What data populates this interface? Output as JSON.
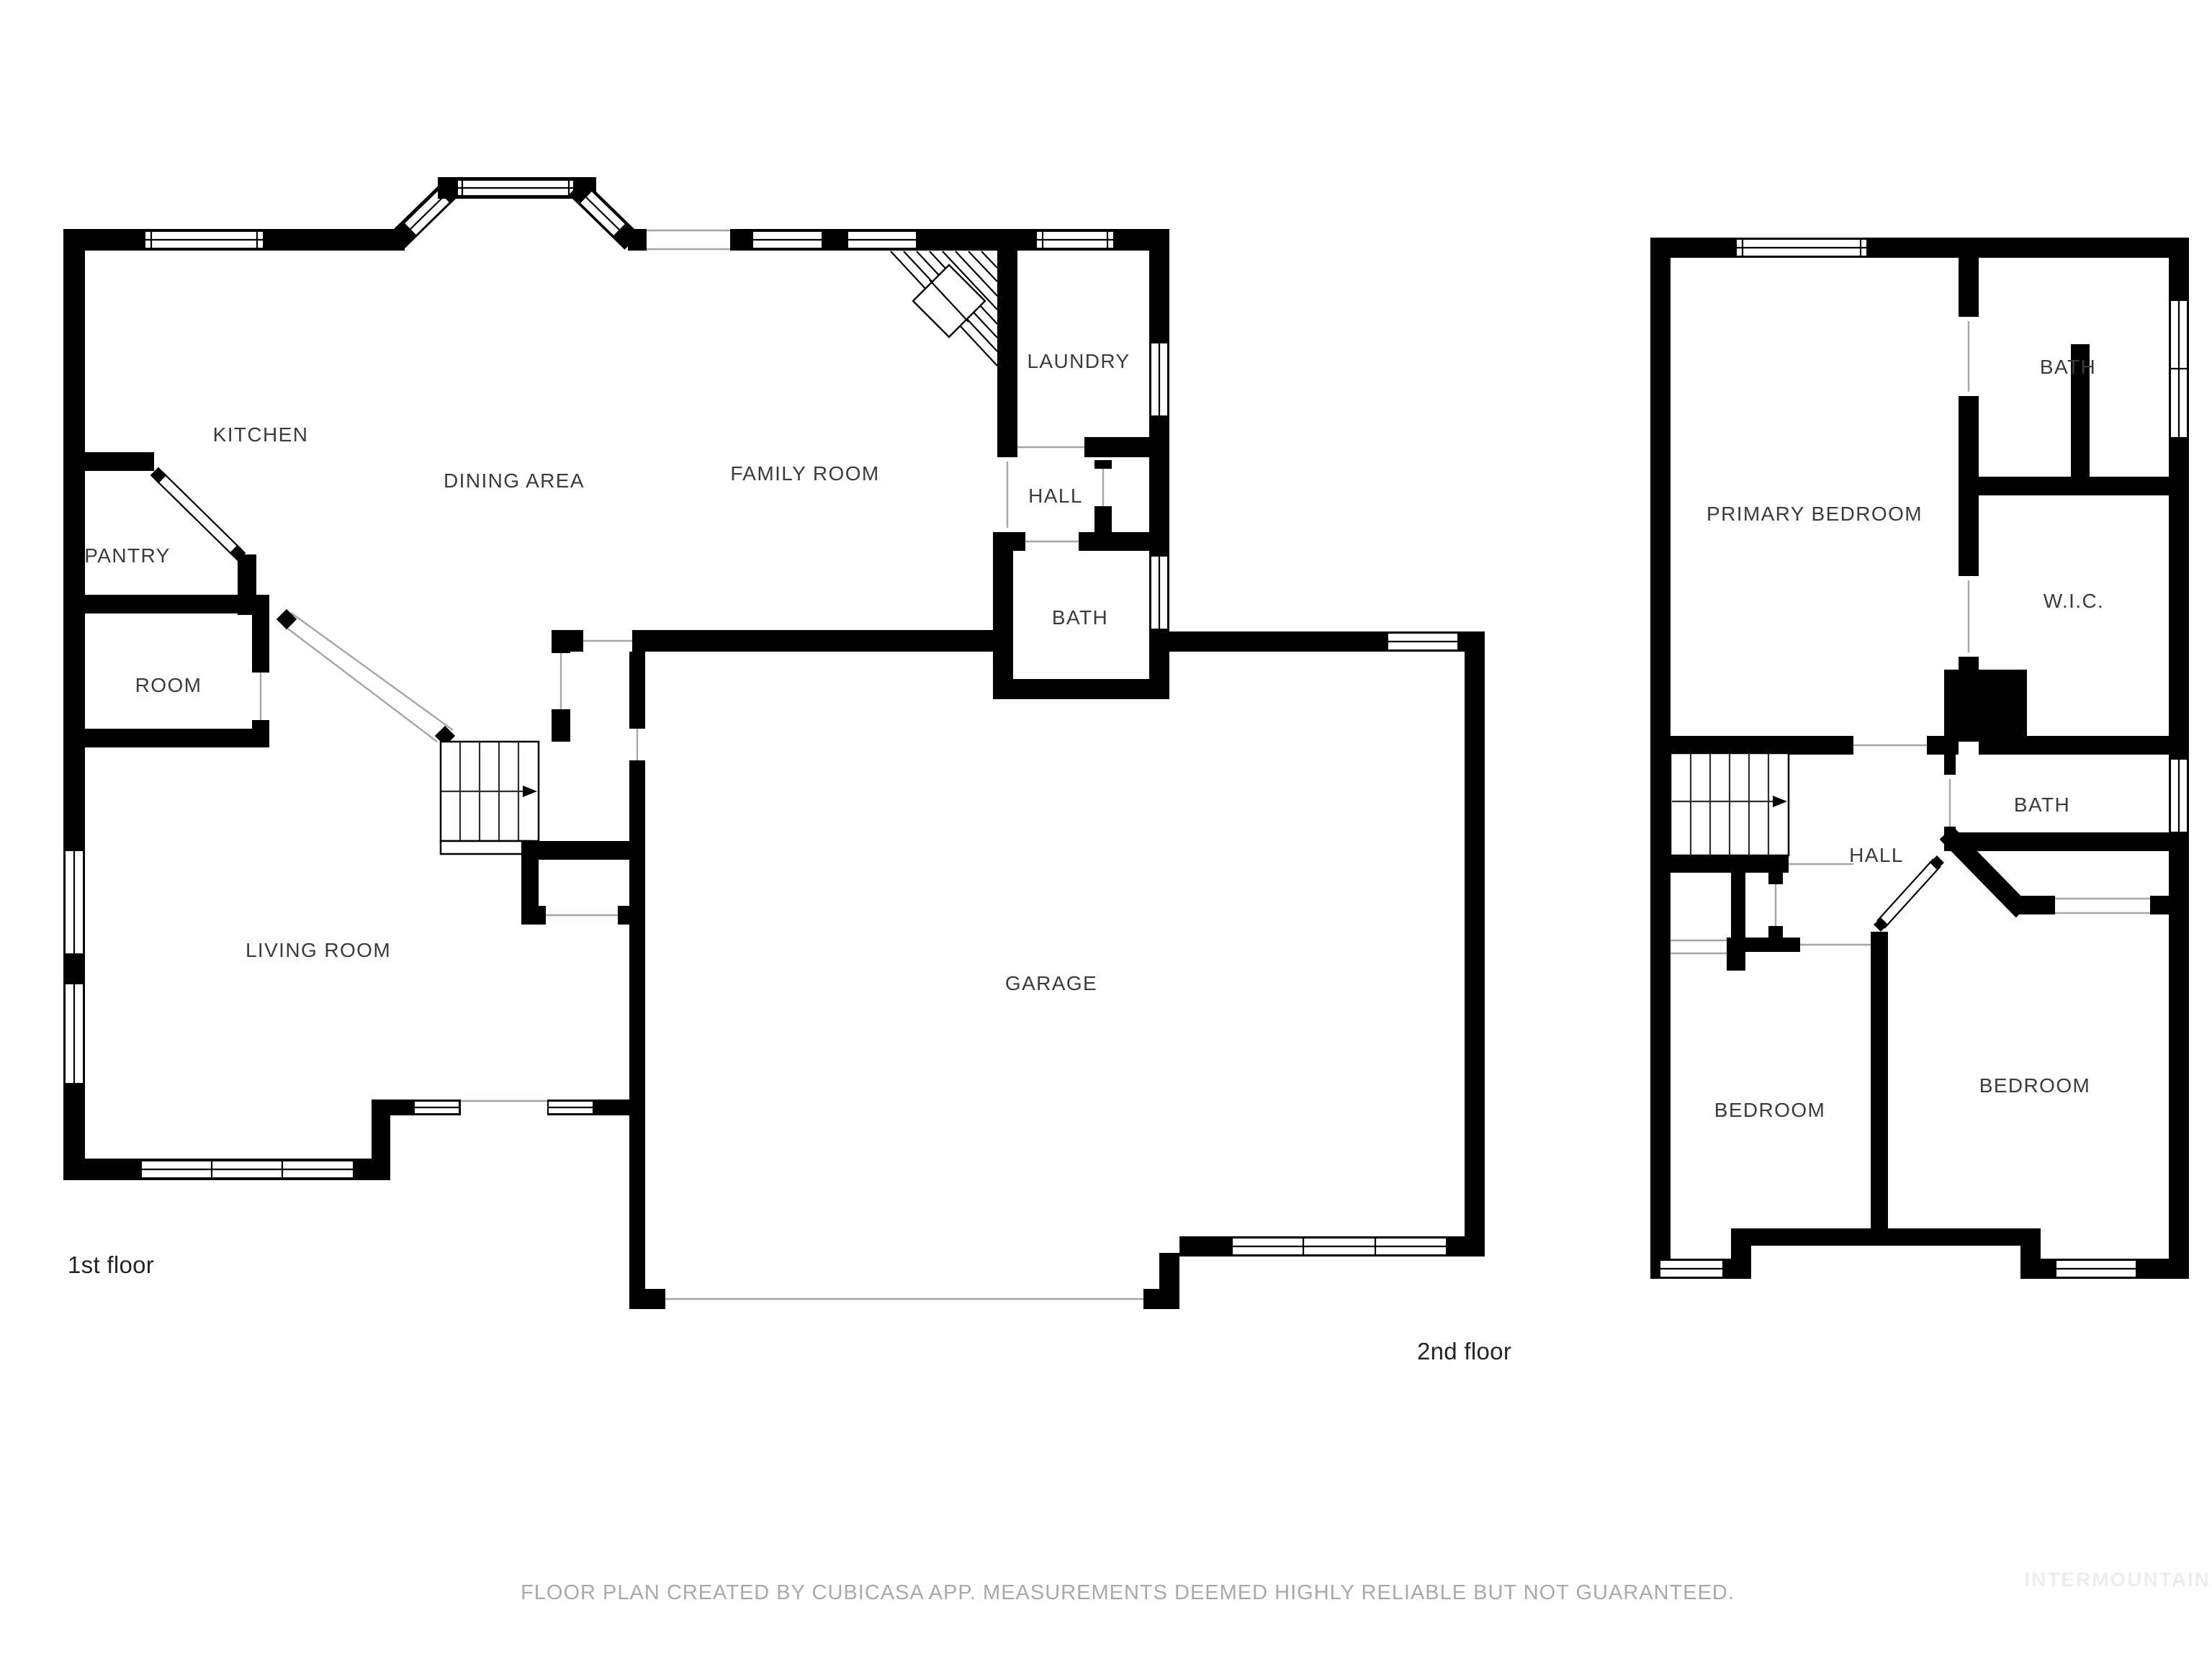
{
  "page": {
    "background": "#ffffff"
  },
  "colors": {
    "walls": "#000000",
    "room_labels": "#3b3b3b",
    "floor_captions": "#252525",
    "disclaimer_text": "#a9a9a9",
    "watermark_text": "#ededed",
    "opening_lines": "#a6a6a6"
  },
  "floor1": {
    "caption": "1st floor",
    "rooms": {
      "kitchen": "KITCHEN",
      "dining_area": "DINING AREA",
      "family_room": "FAMILY ROOM",
      "laundry": "LAUNDRY",
      "hall": "HALL",
      "bath": "BATH",
      "pantry": "PANTRY",
      "room": "ROOM",
      "living_room": "LIVING ROOM",
      "garage": "GARAGE"
    }
  },
  "floor2": {
    "caption": "2nd floor",
    "rooms": {
      "bath_top": "BATH",
      "primary_bedroom": "PRIMARY BEDROOM",
      "wic": "W.I.C.",
      "bath": "BATH",
      "hall": "HALL",
      "bedroom_left": "BEDROOM",
      "bedroom_right": "BEDROOM"
    }
  },
  "footer": {
    "disclaimer": "FLOOR PLAN CREATED BY CUBICASA APP. MEASUREMENTS DEEMED HIGHLY RELIABLE BUT NOT GUARANTEED.",
    "watermark": "INTERMOUNTAIN"
  }
}
